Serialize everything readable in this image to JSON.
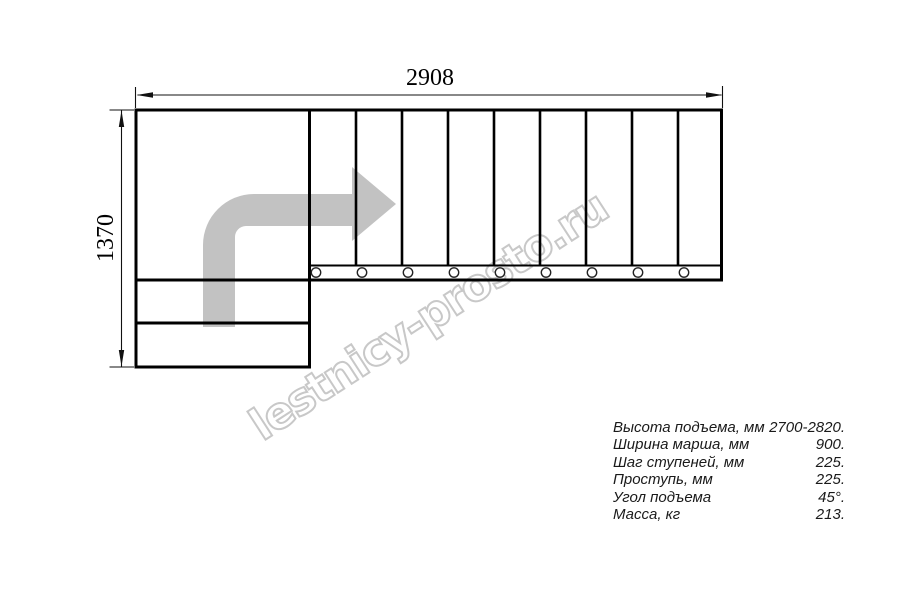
{
  "drawing": {
    "title": "Stair plan view",
    "width_label": "2908",
    "height_label": "1370",
    "treads_count": 9,
    "bolt_circles_count": 9,
    "colors": {
      "line": "#000000",
      "direction_arrow": "#c2c2c2",
      "watermark": "#c8c8c8",
      "background": "#ffffff"
    }
  },
  "watermark": {
    "text": "lestnicy-prosto.ru"
  },
  "specs": {
    "rows": [
      {
        "label": "Высота подъема, мм",
        "value": "2700-2820."
      },
      {
        "label": "Ширина марша, мм",
        "value": "900."
      },
      {
        "label": "Шаг ступеней, мм",
        "value": "225."
      },
      {
        "label": "Проступь, мм",
        "value": "225."
      },
      {
        "label": "Угол подъема",
        "value": "45°."
      },
      {
        "label": "Масса, кг",
        "value": "213."
      }
    ]
  }
}
